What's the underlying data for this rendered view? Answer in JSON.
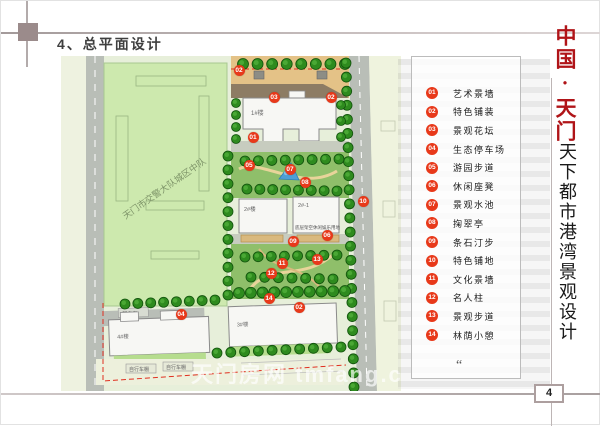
{
  "page": {
    "title": "4、总平面设计",
    "page_number": "4",
    "watermark": "天门房网 tmfang.com"
  },
  "brand": {
    "title_red": "中国·天门",
    "subtitle": "天下都市港湾景观设计",
    "red_color": "#b01418"
  },
  "legend": {
    "quote_mark": "“",
    "marker_color": "#e8391a",
    "items": [
      {
        "num": "01",
        "label": "艺术景墙"
      },
      {
        "num": "02",
        "label": "特色铺装"
      },
      {
        "num": "03",
        "label": "景观花坛"
      },
      {
        "num": "04",
        "label": "生态停车场"
      },
      {
        "num": "05",
        "label": "游园步道"
      },
      {
        "num": "06",
        "label": "休闲座凳"
      },
      {
        "num": "07",
        "label": "景观水池"
      },
      {
        "num": "08",
        "label": "掬翠亭"
      },
      {
        "num": "09",
        "label": "条石汀步"
      },
      {
        "num": "10",
        "label": "特色铺地"
      },
      {
        "num": "11",
        "label": "文化景墙"
      },
      {
        "num": "12",
        "label": "名人柱"
      },
      {
        "num": "13",
        "label": "景观步道"
      },
      {
        "num": "14",
        "label": "林荫小憩"
      }
    ]
  },
  "plan": {
    "labels": {
      "neighbor_parcel": "天门市交警大队城区中队",
      "building_1": "1#楼",
      "building_2a": "2#楼",
      "building_2b": "2#-1",
      "building_2_caption": "底层架空休闲娱乐用地",
      "building_3": "3#楼",
      "building_4": "4#楼",
      "power_room": "配电房",
      "bike_shed_1": "自行车棚",
      "bike_shed_2": "自行车棚"
    },
    "markers": [
      {
        "num": "02",
        "x": 238,
        "y": 69
      },
      {
        "num": "03",
        "x": 273,
        "y": 96
      },
      {
        "num": "02",
        "x": 330,
        "y": 96
      },
      {
        "num": "01",
        "x": 252,
        "y": 136
      },
      {
        "num": "05",
        "x": 248,
        "y": 164
      },
      {
        "num": "07",
        "x": 289,
        "y": 168
      },
      {
        "num": "08",
        "x": 304,
        "y": 181
      },
      {
        "num": "06",
        "x": 326,
        "y": 234
      },
      {
        "num": "10",
        "x": 362,
        "y": 200
      },
      {
        "num": "09",
        "x": 292,
        "y": 240
      },
      {
        "num": "11",
        "x": 281,
        "y": 262
      },
      {
        "num": "12",
        "x": 270,
        "y": 272
      },
      {
        "num": "13",
        "x": 316,
        "y": 258
      },
      {
        "num": "14",
        "x": 268,
        "y": 297
      },
      {
        "num": "04",
        "x": 180,
        "y": 313
      },
      {
        "num": "02",
        "x": 298,
        "y": 306
      }
    ]
  }
}
